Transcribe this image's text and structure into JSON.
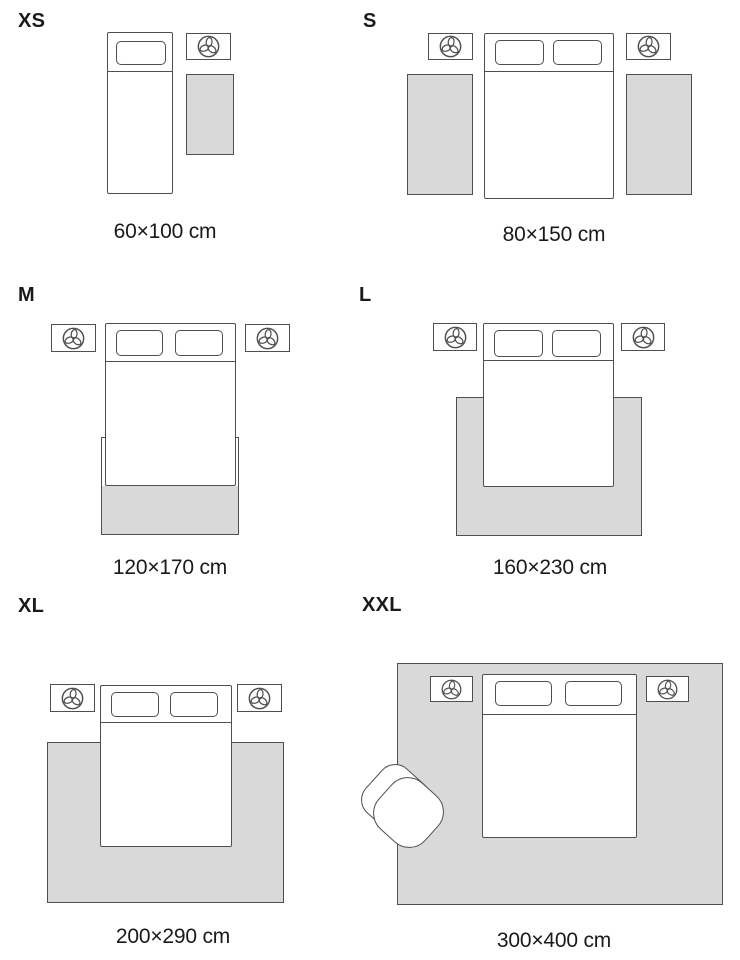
{
  "panels": [
    {
      "size": "XS",
      "dimensions": "60×100 cm"
    },
    {
      "size": "S",
      "dimensions": "80×150 cm"
    },
    {
      "size": "M",
      "dimensions": "120×170 cm"
    },
    {
      "size": "L",
      "dimensions": "160×230 cm"
    },
    {
      "size": "XL",
      "dimensions": "200×290 cm"
    },
    {
      "size": "XXL",
      "dimensions": "300×400 cm"
    }
  ],
  "icons": {
    "nightstand_decor": "plant-icon"
  },
  "colors": {
    "rug_fill": "#d9d9d9",
    "outline": "#4f4f4f",
    "text": "#1a1a1a",
    "background": "#ffffff"
  }
}
